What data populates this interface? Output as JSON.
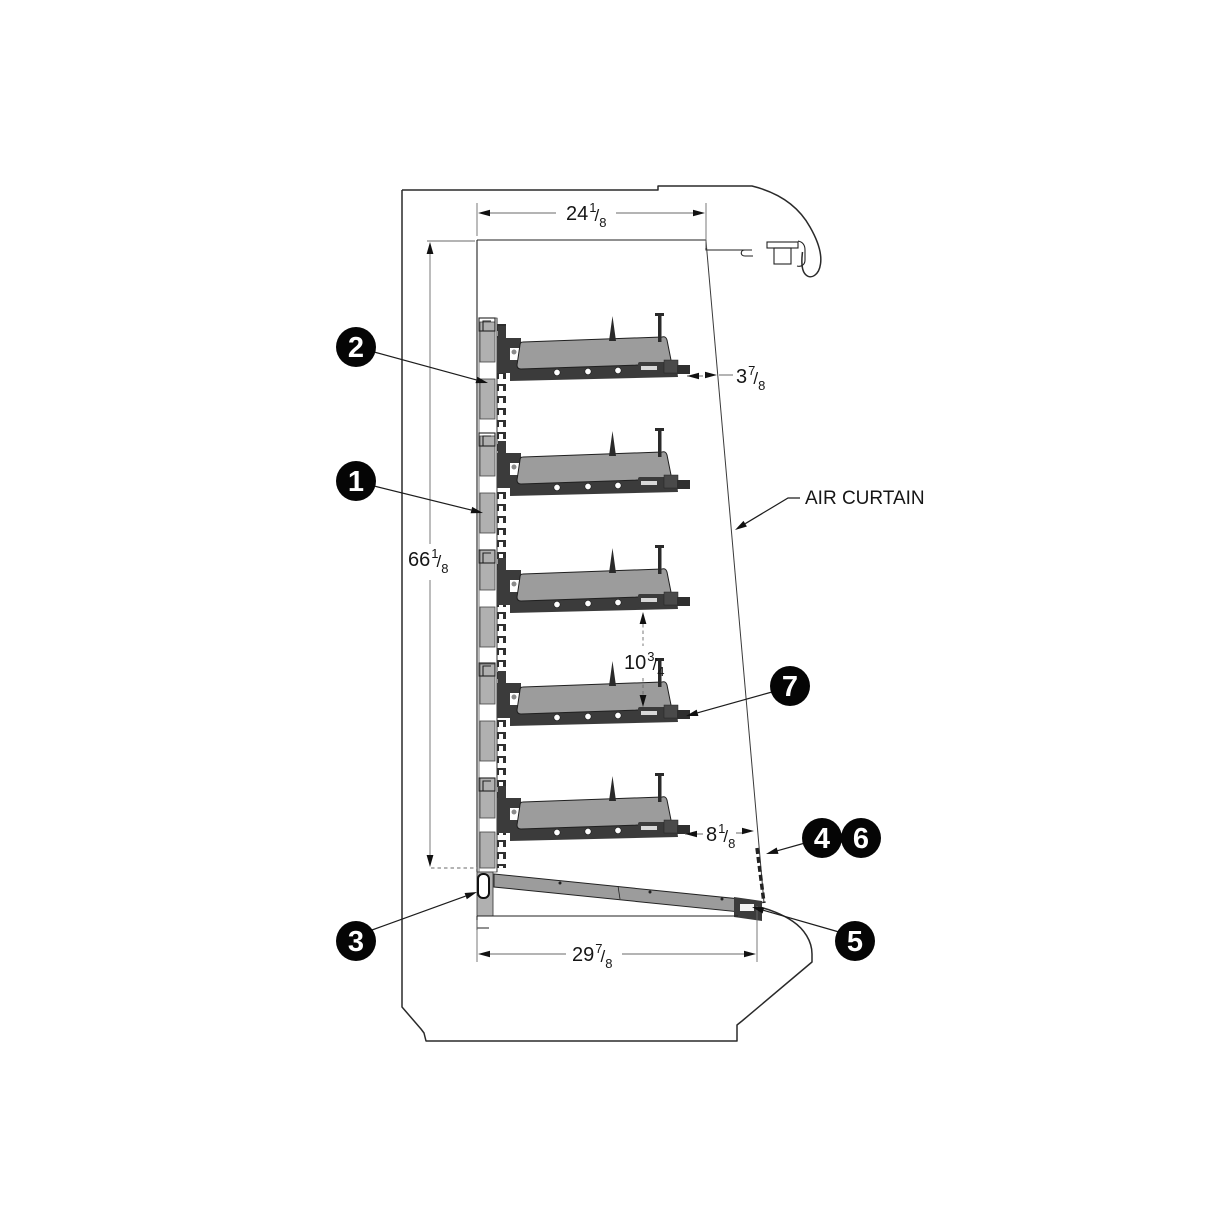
{
  "diagram": {
    "kind": "technical-line-drawing",
    "subject": "open-front refrigerated merchandiser side cross-section",
    "shelf_count": 5,
    "colors": {
      "line": "#1a1a1a",
      "shelf_gray": "#9c9c9c",
      "hardware_dark": "#3b3b3b",
      "standard_gray": "#b0b0b0",
      "balloon": "#000000",
      "balloon_text": "#ffffff"
    }
  },
  "labels": {
    "air_curtain": "AIR CURTAIN",
    "fraction_slash": "/"
  },
  "dimensions": {
    "top_depth": {
      "whole": "24",
      "num": "1",
      "den": "8",
      "text": "24 1/8"
    },
    "interior_height": {
      "whole": "66",
      "num": "1",
      "den": "8",
      "text": "66 1/8"
    },
    "shelf_front_to_air_curtain_top": {
      "whole": "3",
      "num": "7",
      "den": "8",
      "text": "3 7/8"
    },
    "shelf_vertical_clearance": {
      "whole": "10",
      "num": "3",
      "den": "4",
      "text": "10 3/4"
    },
    "shelf_front_to_air_curtain_bottom": {
      "whole": "8",
      "num": "1",
      "den": "8",
      "text": "8 1/8"
    },
    "base_depth": {
      "whole": "29",
      "num": "7",
      "den": "8",
      "text": "29 7/8"
    }
  },
  "callouts": {
    "c1": {
      "number": "1"
    },
    "c2": {
      "number": "2"
    },
    "c3": {
      "number": "3"
    },
    "c4": {
      "number": "4"
    },
    "c5": {
      "number": "5"
    },
    "c6": {
      "number": "6"
    },
    "c7": {
      "number": "7"
    }
  }
}
